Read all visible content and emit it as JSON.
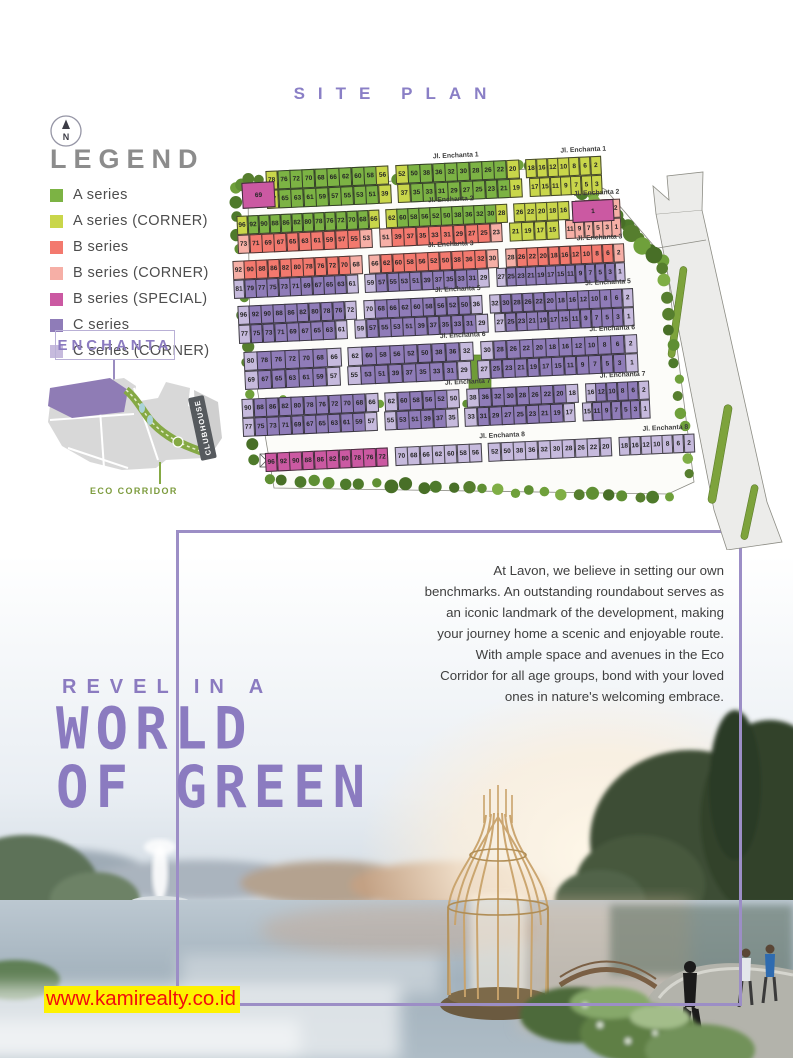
{
  "page": {
    "title": "SITE PLAN",
    "watermark": "www.kamirealty.co.id",
    "compass": "N"
  },
  "colors": {
    "accent_purple": "#8b7bc0",
    "frame_purple": "#9c8ec6",
    "watermark_bg": "#fef200",
    "watermark_text": "#f20d0d",
    "eco_green": "#7d9c3e",
    "palette": {
      "a": "#7cb344",
      "ac": "#c9d64a",
      "b": "#f3796e",
      "bc": "#f6afa6",
      "bs": "#cb59a2",
      "c": "#8f7cb8",
      "cc": "#c6badd"
    }
  },
  "legend": {
    "heading": "LEGEND",
    "items": [
      {
        "label": "A series",
        "color": "#7cb344"
      },
      {
        "label": "A series (CORNER)",
        "color": "#c9d64a"
      },
      {
        "label": "B series",
        "color": "#f3796e"
      },
      {
        "label": "B series (CORNER)",
        "color": "#f6afa6"
      },
      {
        "label": "B series (SPECIAL)",
        "color": "#cb59a2"
      },
      {
        "label": "C series",
        "color": "#8f7cb8"
      },
      {
        "label": "C series (CORNER)",
        "color": "#c6badd"
      }
    ]
  },
  "minimap": {
    "project": "ENCHANTA",
    "clubhouse": "CLUBHOUSE",
    "eco_corridor": "ECO CORRIDOR"
  },
  "siteplan": {
    "special_lots": [
      {
        "n": "69",
        "color": "bs",
        "x": 20,
        "y": 34,
        "w": 31,
        "h": 24
      },
      {
        "n": "1",
        "color": "bs",
        "x": 350,
        "y": 52,
        "w": 40,
        "h": 20
      }
    ],
    "bands": [
      {
        "street": "Jl. Enchanta 1",
        "rows": [
          [
            {
              "base": "a",
              "corner": "ac",
              "lots": [
                78,
                76,
                72,
                70,
                68,
                66,
                62,
                60,
                58,
                56
              ]
            },
            {
              "base": "a",
              "corner": "ac",
              "lots": [
                52,
                50,
                38,
                36,
                32,
                30,
                28,
                26,
                22,
                20
              ]
            },
            {
              "base": "ac",
              "lots": [
                18,
                16,
                12,
                10,
                8,
                6,
                2
              ]
            }
          ],
          [
            {
              "base": "a",
              "corner": "ac",
              "lots": [
                67,
                65,
                63,
                61,
                59,
                57,
                55,
                53,
                51,
                39
              ]
            },
            {
              "base": "a",
              "corner": "ac",
              "lots": [
                37,
                35,
                33,
                31,
                29,
                27,
                25,
                23,
                21,
                19
              ]
            },
            {
              "base": "ac",
              "lots": [
                17,
                15,
                11,
                9,
                7,
                5,
                3
              ]
            }
          ]
        ]
      },
      {
        "street": "Jl. Enchanta 2",
        "rows": [
          [
            {
              "base": "a",
              "corner": "ac",
              "lots": [
                96,
                92,
                90,
                88,
                86,
                82,
                80,
                78,
                76,
                72,
                70,
                68,
                66
              ]
            },
            {
              "base": "a",
              "corner": "ac",
              "lots": [
                62,
                60,
                58,
                56,
                52,
                50,
                38,
                36,
                32,
                30,
                28
              ]
            },
            {
              "base": "ac",
              "lots": [
                26,
                22,
                20,
                18,
                16
              ]
            },
            {
              "base": "b",
              "corner": "bc",
              "lots": [
                12,
                10,
                8,
                6,
                2
              ]
            }
          ],
          [
            {
              "base": "b",
              "corner": "bc",
              "lots": [
                73,
                71,
                69,
                67,
                65,
                63,
                61,
                59,
                57,
                55,
                53
              ]
            },
            {
              "base": "b",
              "corner": "bc",
              "lots": [
                51,
                39,
                37,
                35,
                33,
                31,
                29,
                27,
                25,
                23
              ]
            },
            {
              "base": "ac",
              "lots": [
                21,
                19,
                17,
                15
              ]
            },
            {
              "base": "bc",
              "lots": [
                11,
                9,
                7,
                5,
                3,
                1
              ]
            }
          ]
        ]
      },
      {
        "street": "Jl. Enchanta 3",
        "rows": [
          [
            {
              "base": "b",
              "corner": "bc",
              "lots": [
                92,
                90,
                88,
                86,
                82,
                80,
                78,
                76,
                72,
                70,
                68
              ]
            },
            {
              "base": "b",
              "corner": "bc",
              "lots": [
                66,
                62,
                60,
                58,
                56,
                52,
                50,
                38,
                36,
                32,
                30
              ]
            },
            {
              "base": "b",
              "corner": "bc",
              "lots": [
                28,
                26,
                22,
                20,
                18,
                16,
                12,
                10,
                8,
                6,
                2
              ]
            }
          ],
          [
            {
              "base": "c",
              "corner": "cc",
              "lots": [
                81,
                79,
                77,
                75,
                73,
                71,
                69,
                67,
                65,
                63,
                61
              ]
            },
            {
              "base": "c",
              "corner": "cc",
              "lots": [
                59,
                57,
                55,
                53,
                51,
                39,
                37,
                35,
                33,
                31,
                29
              ]
            },
            {
              "base": "c",
              "corner": "cc",
              "lots": [
                27,
                25,
                23,
                21,
                19,
                17,
                15,
                11,
                9,
                7,
                5,
                3,
                1
              ]
            }
          ]
        ]
      },
      {
        "street": "Jl. Enchanta 5",
        "rows": [
          [
            {
              "base": "c",
              "corner": "cc",
              "lots": [
                96,
                92,
                90,
                88,
                86,
                82,
                80,
                78,
                76,
                72
              ]
            },
            {
              "base": "c",
              "corner": "cc",
              "lots": [
                70,
                68,
                66,
                62,
                60,
                58,
                56,
                52,
                50,
                36
              ]
            },
            {
              "base": "c",
              "corner": "cc",
              "lots": [
                32,
                30,
                28,
                26,
                22,
                20,
                18,
                16,
                12,
                10,
                8,
                6,
                2
              ]
            }
          ],
          [
            {
              "base": "c",
              "corner": "cc",
              "lots": [
                77,
                75,
                73,
                71,
                69,
                67,
                65,
                63,
                61
              ]
            },
            {
              "base": "c",
              "corner": "cc",
              "lots": [
                59,
                57,
                55,
                53,
                51,
                39,
                37,
                35,
                33,
                31,
                29
              ]
            },
            {
              "base": "c",
              "corner": "cc",
              "lots": [
                27,
                25,
                23,
                21,
                19,
                17,
                15,
                11,
                9,
                7,
                5,
                3,
                1
              ]
            }
          ]
        ]
      },
      {
        "street": "Jl. Enchanta 6",
        "rows": [
          [
            {
              "base": "c",
              "corner": "cc",
              "lots": [
                80,
                78,
                76,
                72,
                70,
                68,
                66
              ]
            },
            {
              "base": "c",
              "corner": "cc",
              "lots": [
                62,
                60,
                58,
                56,
                52,
                50,
                38,
                36,
                32
              ]
            },
            {
              "base": "c",
              "corner": "cc",
              "lots": [
                30,
                28,
                26,
                22,
                20,
                18,
                16,
                12,
                10,
                8,
                6,
                2
              ]
            }
          ],
          [
            {
              "base": "c",
              "corner": "cc",
              "lots": [
                69,
                67,
                65,
                63,
                61,
                59,
                57
              ]
            },
            {
              "base": "c",
              "corner": "cc",
              "lots": [
                55,
                53,
                51,
                39,
                37,
                35,
                33,
                31,
                29
              ]
            },
            {
              "base": "c",
              "corner": "cc",
              "lots": [
                27,
                25,
                23,
                21,
                19,
                17,
                15,
                11,
                9,
                7,
                5,
                3,
                1
              ]
            }
          ]
        ]
      },
      {
        "street": "Jl. Enchanta 7",
        "rows": [
          [
            {
              "base": "c",
              "corner": "cc",
              "lots": [
                90,
                88,
                86,
                82,
                80,
                78,
                76,
                72,
                70,
                68,
                66
              ]
            },
            {
              "base": "c",
              "corner": "cc",
              "lots": [
                62,
                60,
                58,
                56,
                52,
                50
              ]
            },
            {
              "base": "c",
              "corner": "cc",
              "lots": [
                38,
                36,
                32,
                30,
                28,
                26,
                22,
                20,
                18
              ]
            },
            {
              "base": "c",
              "corner": "cc",
              "lots": [
                16,
                12,
                10,
                8,
                6,
                2
              ]
            }
          ],
          [
            {
              "base": "c",
              "corner": "cc",
              "lots": [
                77,
                75,
                73,
                71,
                69,
                67,
                65,
                63,
                61,
                59,
                57
              ]
            },
            {
              "base": "c",
              "corner": "cc",
              "lots": [
                55,
                53,
                51,
                39,
                37,
                35
              ]
            },
            {
              "base": "c",
              "corner": "cc",
              "lots": [
                33,
                31,
                29,
                27,
                25,
                23,
                21,
                19,
                17
              ]
            },
            {
              "base": "c",
              "corner": "cc",
              "lots": [
                15,
                11,
                9,
                7,
                5,
                3,
                1
              ]
            }
          ]
        ]
      },
      {
        "street": "Jl. Enchanta 8",
        "rows": [
          [
            {
              "base": "bs",
              "lots": [
                96,
                92,
                90,
                88,
                86,
                82,
                80,
                78,
                76,
                72
              ]
            },
            {
              "base": "cc",
              "lots": [
                70,
                68,
                66,
                62,
                60,
                58,
                56
              ]
            },
            {
              "base": "cc",
              "lots": [
                52,
                50,
                38,
                36,
                32,
                30,
                28,
                26,
                22,
                20
              ]
            },
            {
              "base": "cc",
              "lots": [
                18,
                16,
                12,
                10,
                8,
                6,
                2
              ]
            }
          ]
        ]
      }
    ]
  },
  "body": {
    "paragraph": "At Lavon, we believe in setting our own benchmarks. An outstanding roundabout serves as an iconic landmark of the development, making your journey home a scenic and enjoyable route. With ample space and avenues in the Eco Corridor for all age groups, bond with your loved ones in nature's welcoming embrace.",
    "kicker": "REVEL IN A",
    "headline1": "WORLD",
    "headline2": "OF GREEN"
  }
}
